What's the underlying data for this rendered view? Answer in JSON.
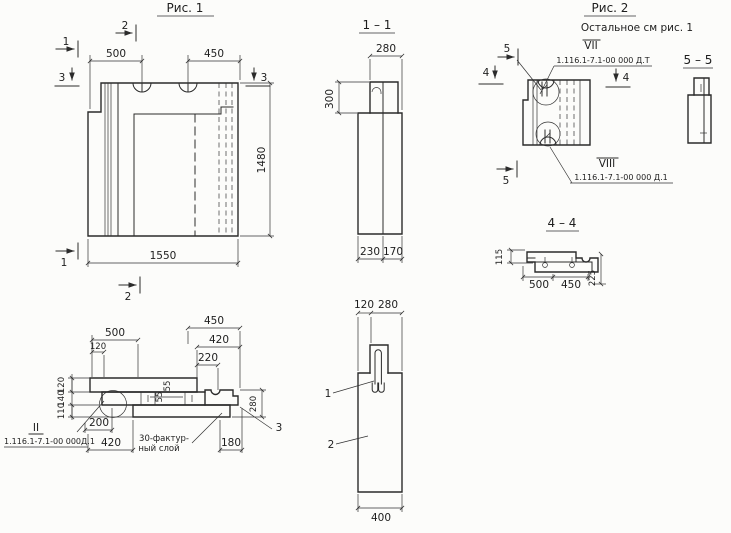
{
  "figure1": {
    "title": "Рис. 1",
    "dim_500": "500",
    "dim_450": "450",
    "dim_1480": "1480",
    "dim_1550": "1550",
    "marker_1": "1",
    "marker_2": "2",
    "marker_3": "3"
  },
  "section_1_1": {
    "title": "1 – 1",
    "dim_280": "280",
    "dim_300": "300",
    "dim_230": "230",
    "dim_170": "170"
  },
  "figure2": {
    "title": "Рис. 2",
    "subtitle": "Остальное  см  рис. 1",
    "marker_4": "4",
    "marker_5": "5",
    "pos_vii": "VII",
    "doc_vii": "1.116.1-7.1-00 000 Д.Т",
    "pos_viii": "VIII",
    "doc_viii": "1.116.1-7.1-00 000 Д.1"
  },
  "section_5_5": {
    "title": "5 – 5"
  },
  "section_4_4": {
    "title": "4 – 4",
    "dim_115": "115",
    "dim_500": "500",
    "dim_450": "450",
    "dim_225": "225"
  },
  "detail": {
    "dim_500": "500",
    "dim_120_top": "120",
    "dim_450": "450",
    "dim_420_top": "420",
    "dim_220": "220",
    "dim_120_left": "120",
    "dim_140_left": "140",
    "dim_110_left": "110",
    "dim_55_a": "55",
    "dim_55_b": "55",
    "dim_200": "200",
    "dim_420_bottom": "420",
    "dim_180": "180",
    "dim_280": "280",
    "marker_3": "3",
    "pos_ii": "II",
    "doc_ii": "1.116.1-7.1-00 000Д.1",
    "note_line1": "30-фактур-",
    "note_line2": "ный слой"
  },
  "section_vertical": {
    "dim_120": "120",
    "dim_280": "280",
    "dim_400": "400",
    "label_1": "1",
    "label_2": "2"
  },
  "colors": {
    "ink": "#2b2b2b",
    "paper": "#fcfcfa"
  }
}
